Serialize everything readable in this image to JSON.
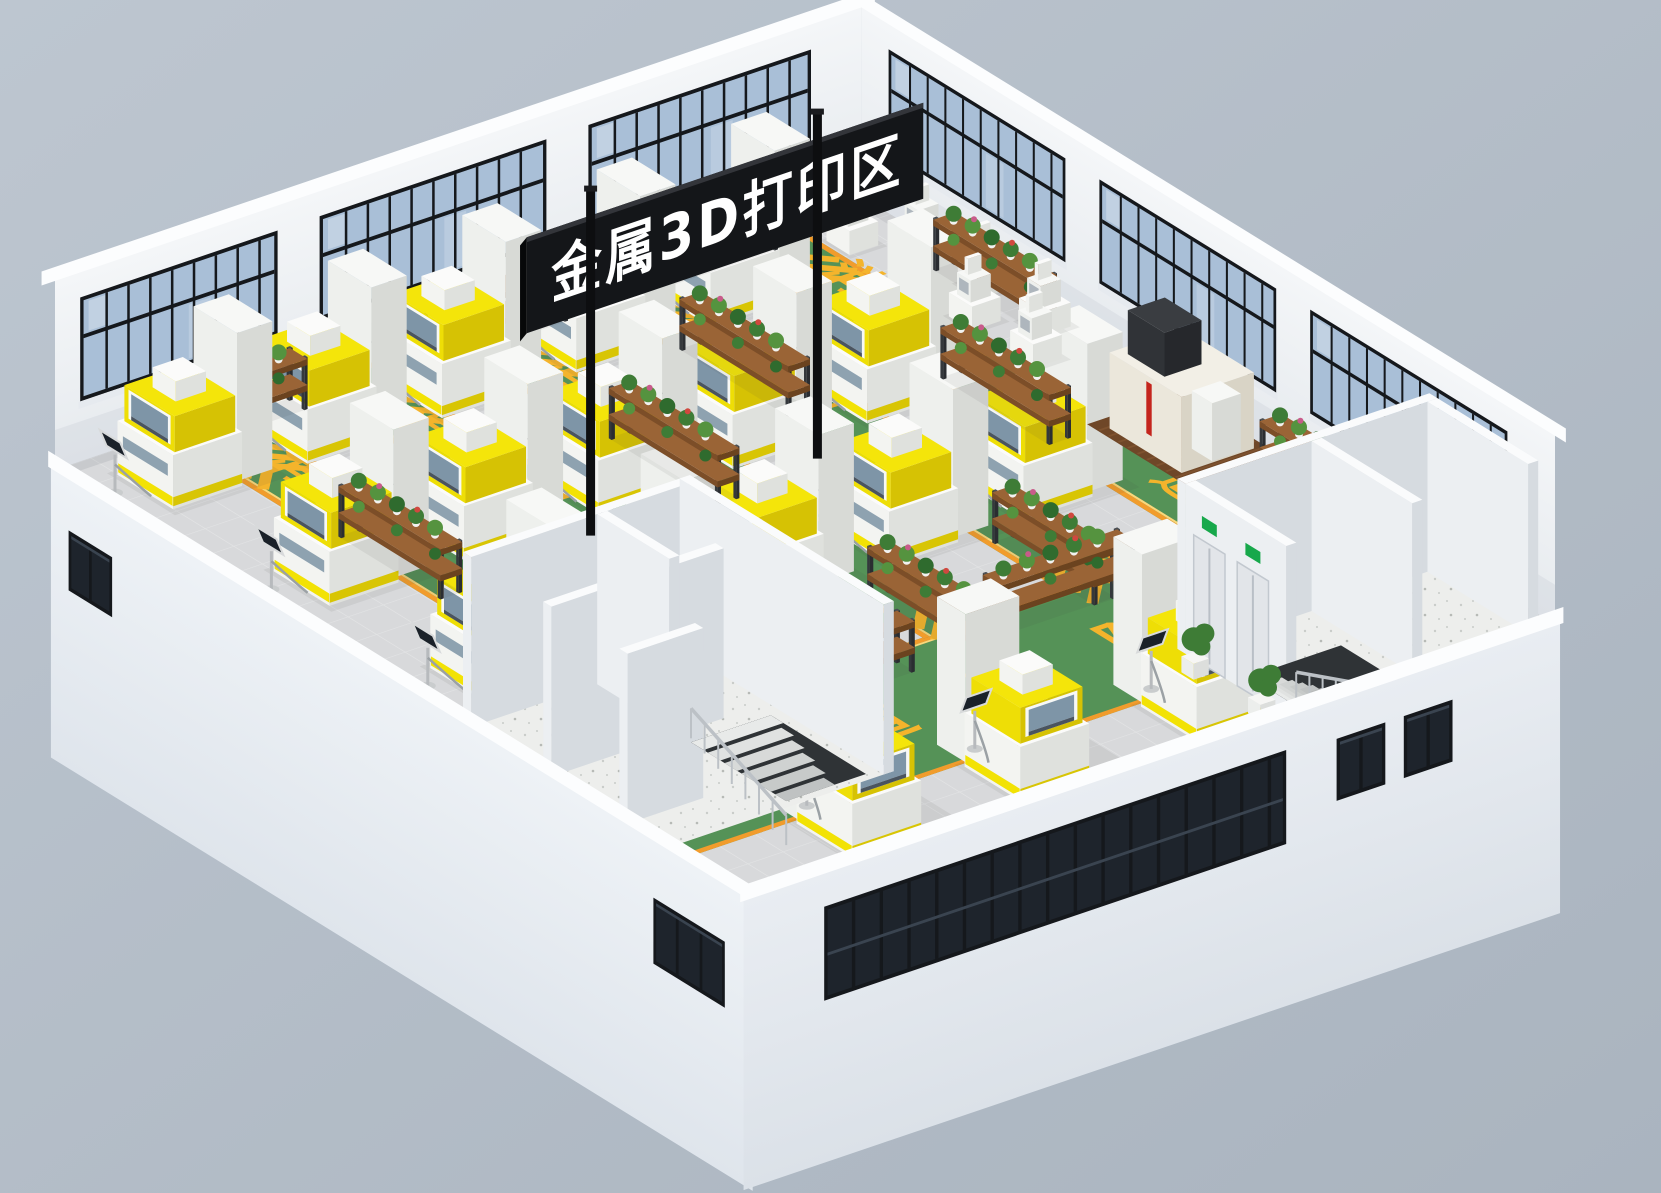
{
  "sign": {
    "text": "金属3D打印区"
  },
  "floor_markings": {
    "lane_text": "消防通道",
    "chars": [
      "消",
      "防",
      "通",
      "道"
    ],
    "text_color": "#f4b42c",
    "lane_color": "#559257",
    "border_color": "#f19c2c",
    "border_inner": "#fbd77a"
  },
  "colors": {
    "background": "#bac3cd",
    "background2": "#aab4bf",
    "wall_face": "#f1f3f6",
    "wall_face2": "#e7ebef",
    "wall_cap": "#fcfdfe",
    "floor_tile": "#d8d9db",
    "tile_line": "#e4e5e6",
    "window_glass": "#a9bfd7",
    "window_glass_light": "#c7d6e5",
    "window_frame": "#15181c",
    "dark_window": "#1e242c",
    "dark_window_line": "#3a4450",
    "machine_top": "#fbfbfa",
    "machine_left": "#f3f4f1",
    "machine_right": "#dfe1dd",
    "cabinet_top": "#f7f8f6",
    "cabinet_left": "#eef0ed",
    "cabinet_right": "#d8dad6",
    "machine_yellow": "#f2e204",
    "machine_yellow_dark": "#d8c504",
    "canopy_window": "#7e95a7",
    "canopy_slat": "#4a545f",
    "body_strip": "#8ea2b0",
    "monitor_screen": "#1a2129",
    "monitor_frame": "#d8dadb",
    "cable": "#9ba1a5",
    "rack_wood_top": "#9a6436",
    "rack_wood_side": "#7c4e28",
    "rack_frame": "#34383c",
    "plant_green_1": "#3e7c36",
    "plant_green_2": "#55933f",
    "plant_green_3": "#2f6b2e",
    "plant_pink": "#c85b8a",
    "plant_red": "#d0483f",
    "pot_white": "#f2f2f0",
    "concrete": "#edeeec",
    "room_wall_top": "#fafbfc",
    "room_wall_left": "#eceff2",
    "room_wall_right": "#d6dbe0",
    "stair_opening": "#2f3336",
    "railing": "#bcc1c6",
    "door_gray": "#e2e5e9",
    "exit_green": "#17a84b",
    "mat_brown": "#6f4728",
    "mat_slat": "#7e522f",
    "cnc_body_top": "#f2efe6",
    "cnc_body_left": "#ebe7db",
    "cnc_body_right": "#d9d4c6",
    "cnc_dark": "#33363a",
    "cnc_red": "#c4251d",
    "sign_bg": "#141619",
    "sign_edge": "#33353a",
    "pole": "#0d0e10",
    "sign_text": "#ffffff",
    "shadow": "rgba(60,70,70,0.08)"
  },
  "scene": {
    "iso": {
      "ox": 55,
      "oy": 470,
      "ex": [
        0.84,
        -0.285
      ],
      "ey": [
        0.68,
        0.42
      ],
      "umax": 960,
      "vmax": 1020,
      "wall_h": 190,
      "facade_drop": 290
    },
    "back_left_wall": {
      "len": 960,
      "window_sections": [
        [
          30,
          265
        ],
        [
          315,
          585
        ],
        [
          635,
          900
        ]
      ]
    },
    "back_right_wall": {
      "len": 1020,
      "window_sections": [
        [
          40,
          300
        ],
        [
          350,
          610
        ],
        [
          660,
          950
        ]
      ]
    },
    "lanes": [
      {
        "u": 830,
        "end": 712
      },
      {
        "u": 665,
        "end": 712
      },
      {
        "u": 500,
        "end": 712
      },
      {
        "u": 335,
        "end": 712
      },
      {
        "u": 170,
        "end": 592
      }
    ],
    "lane_width": 84,
    "lane_char_v": [
      120,
      285,
      450,
      615
    ],
    "lane_chevron_v": [
      52,
      660
    ],
    "bottom_zone": {
      "v0": 710,
      "v1": 925,
      "char_u": [
        790,
        630,
        470,
        310
      ],
      "char_v": 845,
      "chevron_u": [
        884,
        204
      ],
      "chevron_v": 818
    },
    "machine_rows": {
      "u": [
        740,
        580,
        420,
        260,
        100
      ],
      "v": [
        40,
        270,
        500
      ]
    },
    "bottom_machines": [
      [
        540,
        930
      ],
      [
        330,
        930
      ],
      [
        130,
        930
      ]
    ],
    "small_machines": [
      [
        878,
        50
      ],
      [
        878,
        140
      ],
      [
        878,
        230
      ],
      [
        925,
        95
      ],
      [
        925,
        185
      ],
      [
        925,
        275
      ],
      [
        878,
        320
      ]
    ],
    "racks": [
      {
        "u": 120,
        "v": 12,
        "len": 150,
        "o": "u"
      },
      {
        "u": 430,
        "v": 12,
        "len": 150,
        "o": "u"
      },
      {
        "u": 690,
        "v": 12,
        "len": 140,
        "o": "u"
      },
      {
        "u": 924,
        "v": 150,
        "len": 150,
        "o": "v"
      },
      {
        "u": 924,
        "v": 630,
        "len": 140,
        "o": "v"
      },
      {
        "u": 795,
        "v": 320,
        "len": 160,
        "o": "v"
      },
      {
        "u": 630,
        "v": 140,
        "len": 160,
        "o": "v"
      },
      {
        "u": 630,
        "v": 600,
        "len": 150,
        "o": "v"
      },
      {
        "u": 465,
        "v": 240,
        "len": 160,
        "o": "v"
      },
      {
        "u": 465,
        "v": 620,
        "len": 150,
        "o": "v"
      },
      {
        "u": 300,
        "v": 430,
        "len": 160,
        "o": "v"
      },
      {
        "u": 135,
        "v": 250,
        "len": 150,
        "o": "v"
      },
      {
        "u": 135,
        "v": 455,
        "len": 120,
        "o": "v"
      },
      {
        "u": 250,
        "v": 732,
        "len": 160,
        "o": "u"
      },
      {
        "u": 520,
        "v": 722,
        "len": 160,
        "o": "u"
      }
    ],
    "cnc": {
      "u": 862,
      "v": 486,
      "mat": [
        850,
        468,
        110,
        150
      ]
    },
    "annex": {
      "rect": [
        0,
        600,
        270,
        300
      ],
      "walls": [
        [
          0,
          600,
          270,
          12
        ],
        [
          258,
          600,
          12,
          300
        ],
        [
          0,
          718,
          205,
          12
        ],
        [
          150,
          612,
          12,
          106
        ],
        [
          0,
          830,
          90,
          12
        ]
      ],
      "stair": {
        "x": 150,
        "y": 750,
        "w": 95,
        "len": 140,
        "dir": "v"
      }
    },
    "rooms": {
      "rect": [
        640,
        860,
        300,
        160
      ],
      "walls": [
        [
          640,
          860,
          300,
          12
        ],
        [
          640,
          872,
          12,
          148
        ],
        [
          928,
          872,
          12,
          148
        ],
        [
          790,
          872,
          12,
          148
        ]
      ],
      "doors_v": [
        [
          884,
          930
        ],
        [
          948,
          994
        ]
      ],
      "stair": {
        "x": 660,
        "y": 940,
        "w": 70,
        "len": 110,
        "dir": "u"
      }
    },
    "floor_plants": [
      [
        614,
        898
      ],
      [
        614,
        996
      ]
    ],
    "front_left_facade": {
      "len": 1020,
      "windows": [
        {
          "x": 20,
          "w": 64,
          "y": 52,
          "h": 60,
          "panes": 2
        },
        {
          "x": 880,
          "w": 105,
          "y": 58,
          "h": 66,
          "panes": 3
        }
      ]
    },
    "front_right_facade": {
      "len": 960,
      "band": {
        "x": 90,
        "w": 550,
        "y": 34,
        "h": 94
      },
      "windows": [
        {
          "x": 700,
          "w": 58,
          "y": 40,
          "h": 62,
          "panes": 2
        },
        {
          "x": 780,
          "w": 58,
          "y": 40,
          "h": 62,
          "panes": 2
        }
      ]
    },
    "sign_geo": {
      "board_len": 466,
      "board_h": 96,
      "poles_cx": [
        590.6,
        817.4
      ],
      "poles_top": [
        190.6,
        113.6
      ],
      "pole_h": 345,
      "pole_w": 9
    }
  }
}
